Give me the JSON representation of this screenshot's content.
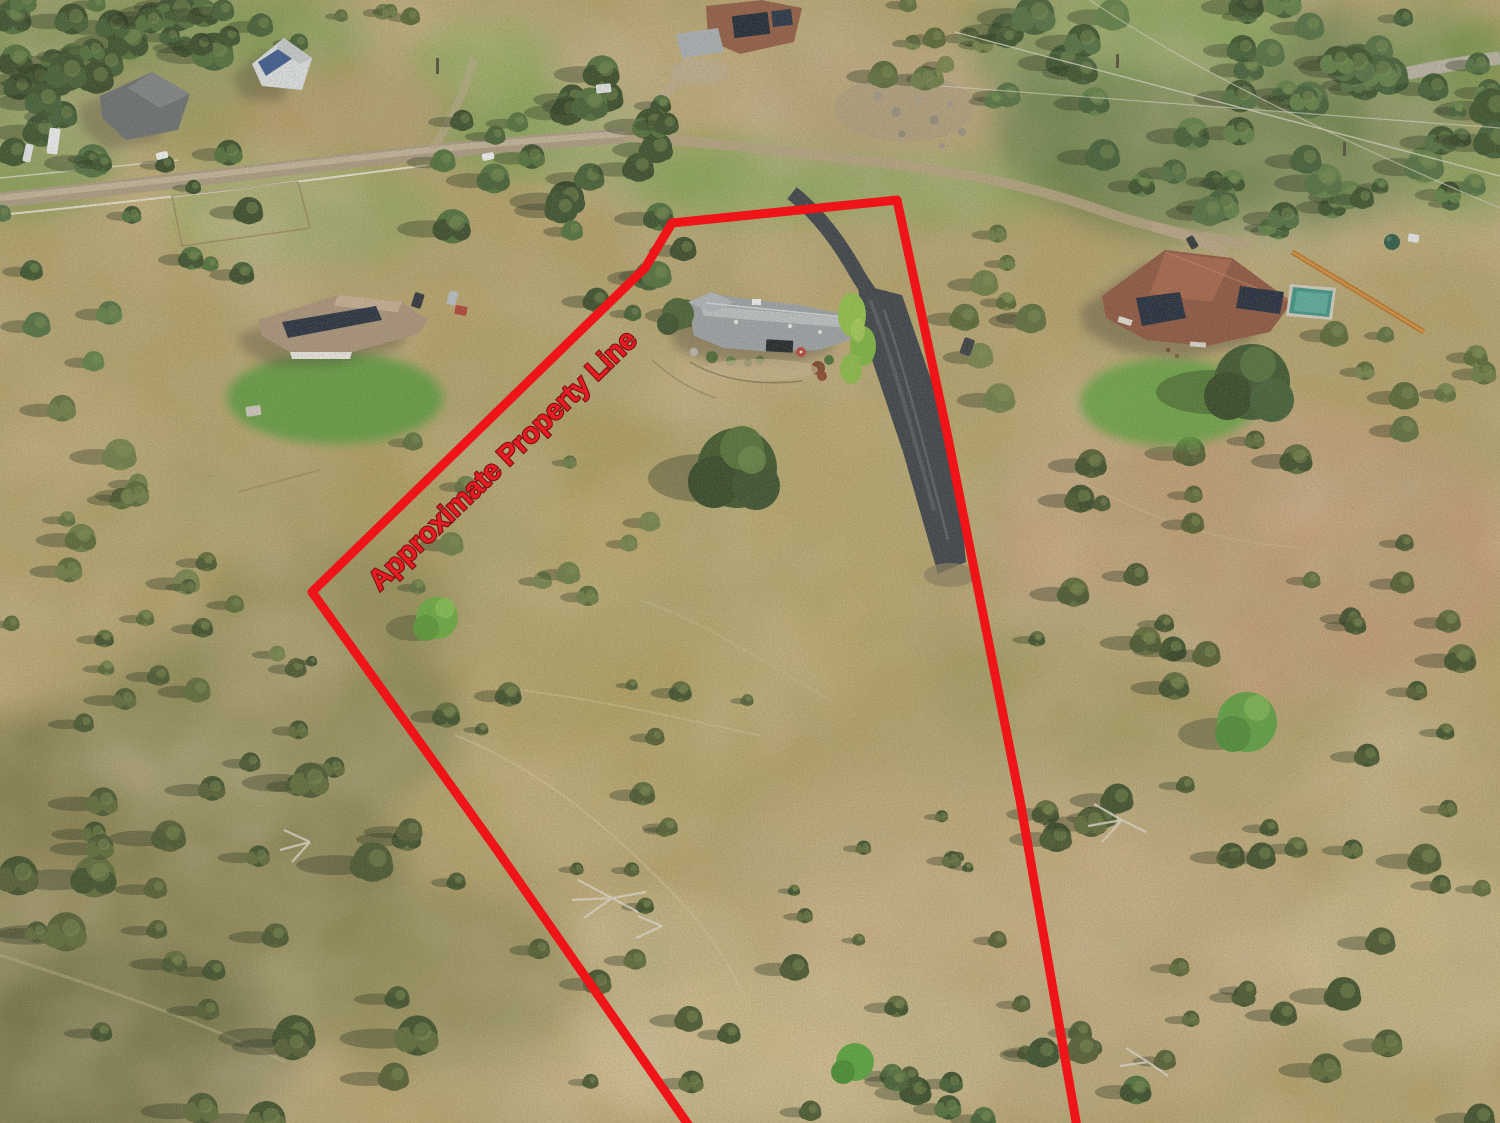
{
  "annotation": {
    "label": "Approximate Property Line",
    "label_color": "#e51d23",
    "label_outline_color": "#7c0f12",
    "line_color": "#ee1418",
    "line_width": 9,
    "property_line_points": "694,1133 497,850 312,592 645,268 672,223 897,200 947,433 1020,800 1078,1133",
    "label_position": {
      "x": 509,
      "y": 467,
      "rotation_deg": -44,
      "font_size": 29
    }
  },
  "scene": {
    "type": "aerial-drone-photo",
    "landmarks": [
      "main-house",
      "curved-asphalt-driveway",
      "neighbor-house-left",
      "neighbor-house-right",
      "swimming-pool",
      "barn-with-solar-panel",
      "dirt-roads",
      "oak-trees",
      "dry-golden-grassland"
    ]
  }
}
